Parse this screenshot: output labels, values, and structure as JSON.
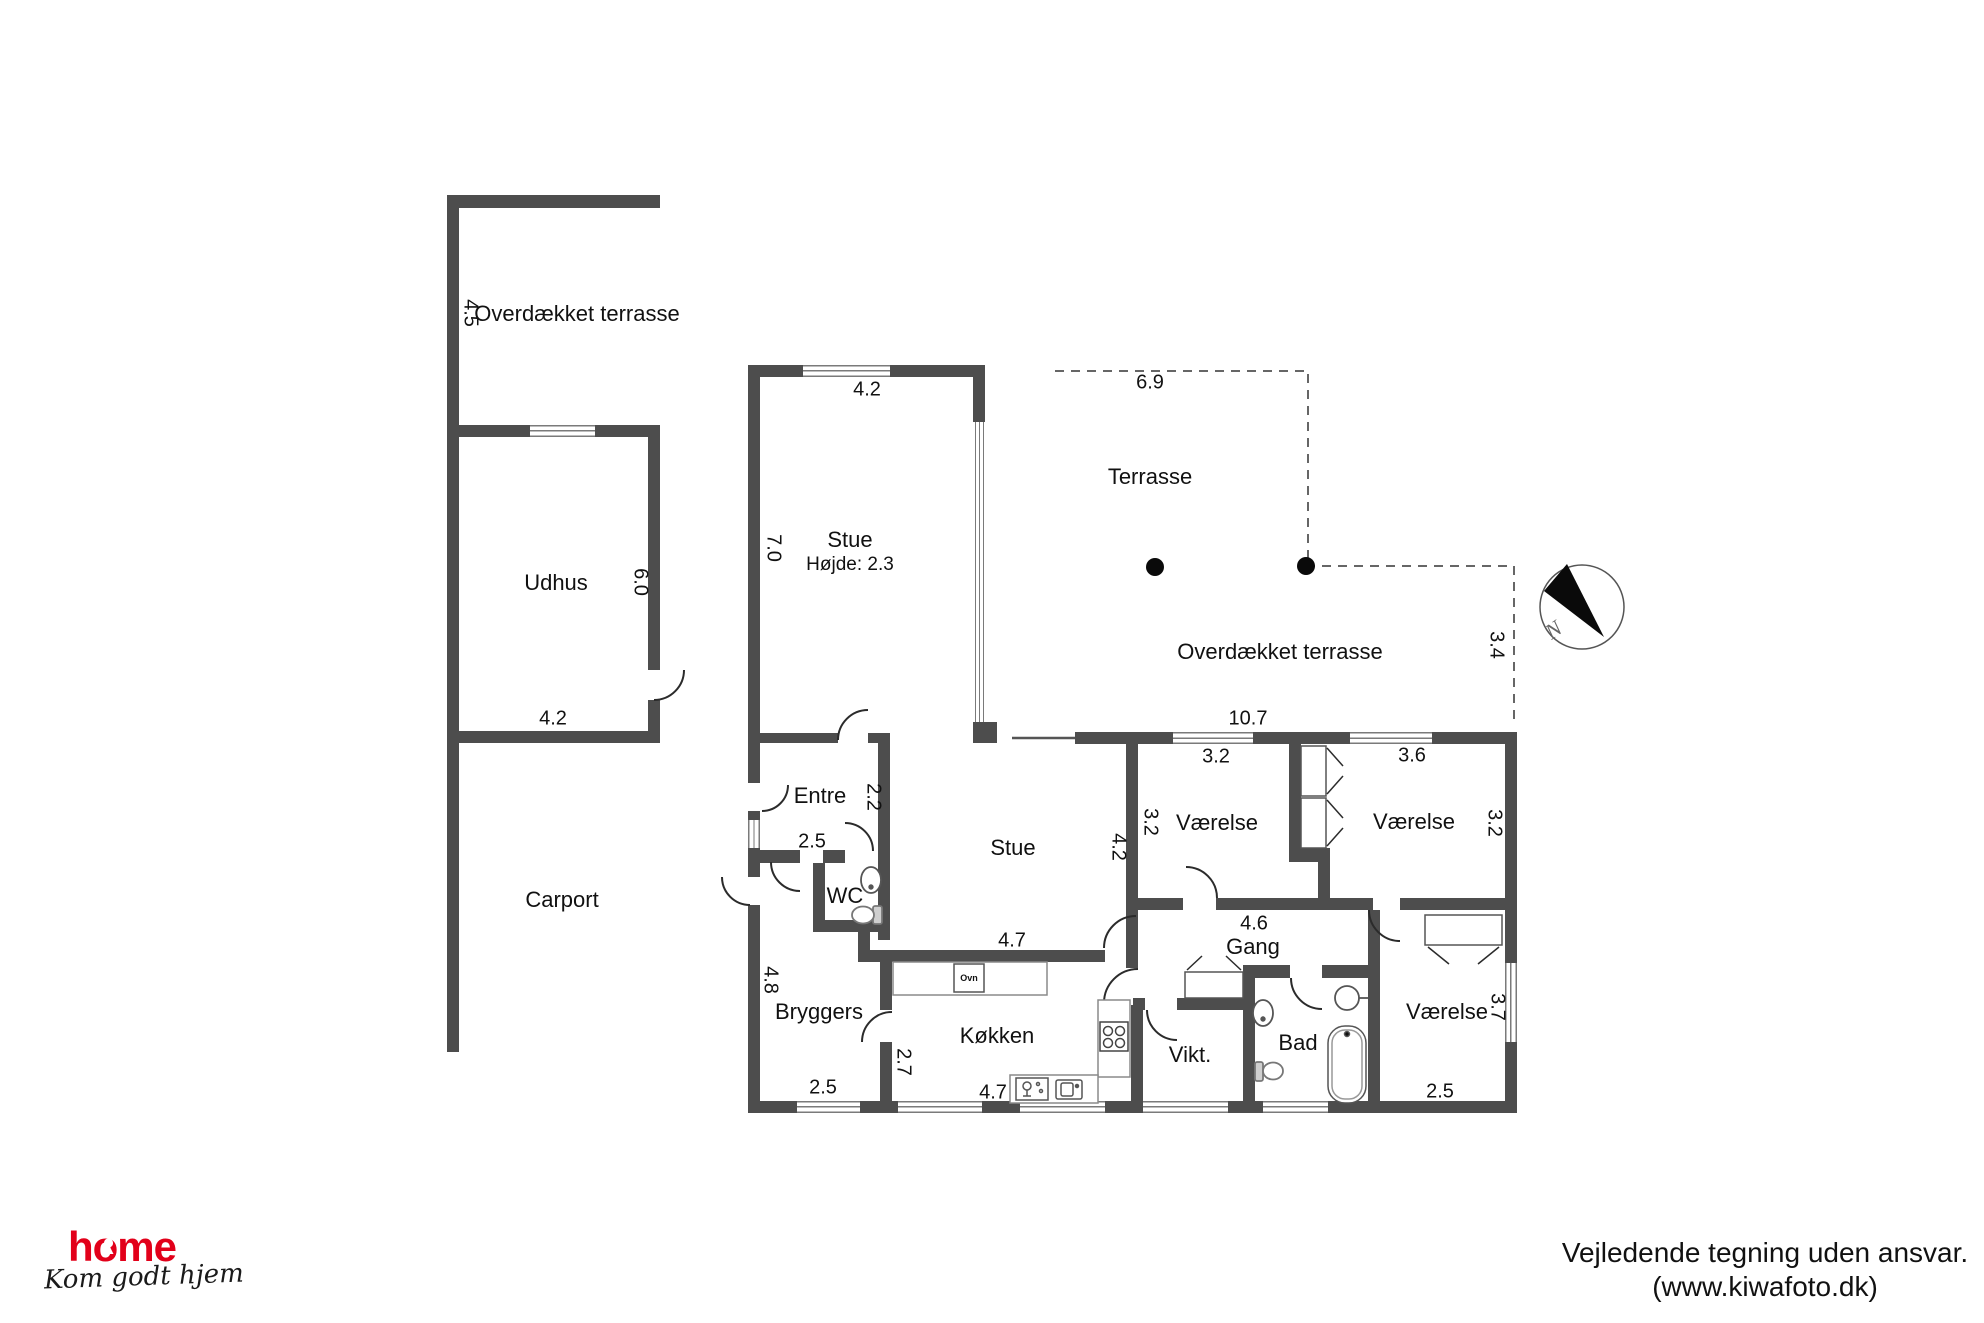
{
  "areas": {
    "terrace_left": {
      "label": "Overdækket terrasse",
      "height_dim": "4.5"
    },
    "udhus": {
      "label": "Udhus",
      "width_dim": "4.2",
      "height_dim": "6.0"
    },
    "carport": {
      "label": "Carport"
    },
    "stue_main": {
      "label": "Stue",
      "height_note": "Højde: 2.3",
      "width_dim": "4.2",
      "height_dim": "7.0"
    },
    "terrace_open": {
      "label": "Terrasse",
      "width_dim": "6.9"
    },
    "terrace_covered": {
      "label": "Overdækket terrasse",
      "width_dim": "10.7",
      "depth_dim": "3.4"
    },
    "entre": {
      "label": "Entre",
      "width_dim": "2.5",
      "height_dim": "2.2"
    },
    "wc": {
      "label": "WC"
    },
    "stue2": {
      "label": "Stue",
      "width_dim": "4.7",
      "height_dim": "4.2"
    },
    "vaerelse_nw": {
      "label": "Værelse",
      "top_dim": "3.2",
      "side_dim": "3.2"
    },
    "vaerelse_ne": {
      "label": "Værelse",
      "top_dim": "3.6",
      "side_dim": "3.2"
    },
    "gang": {
      "label": "Gang",
      "width_dim": "4.6"
    },
    "bryggers": {
      "label": "Bryggers",
      "width_dim": "2.5",
      "height_dim": "4.8"
    },
    "koekken": {
      "label": "Køkken",
      "width_dim": "4.7",
      "height_dim": "2.7",
      "oven_label": "Ovn"
    },
    "vikt": {
      "label": "Vikt."
    },
    "bad": {
      "label": "Bad"
    },
    "vaerelse_se": {
      "label": "Værelse",
      "width_dim": "2.5",
      "height_dim": "3.7"
    }
  },
  "compass": {
    "north_label": "N"
  },
  "branding": {
    "logo_text": "home",
    "tagline": "Kom godt hjem"
  },
  "disclaimer": {
    "line1": "Vejledende tegning uden ansvar.",
    "line2": "(www.kiwafoto.dk)"
  },
  "colors": {
    "wall": "#4d4d4d",
    "thin_line": "#7a7a7a",
    "accent_red": "#e2001a"
  }
}
